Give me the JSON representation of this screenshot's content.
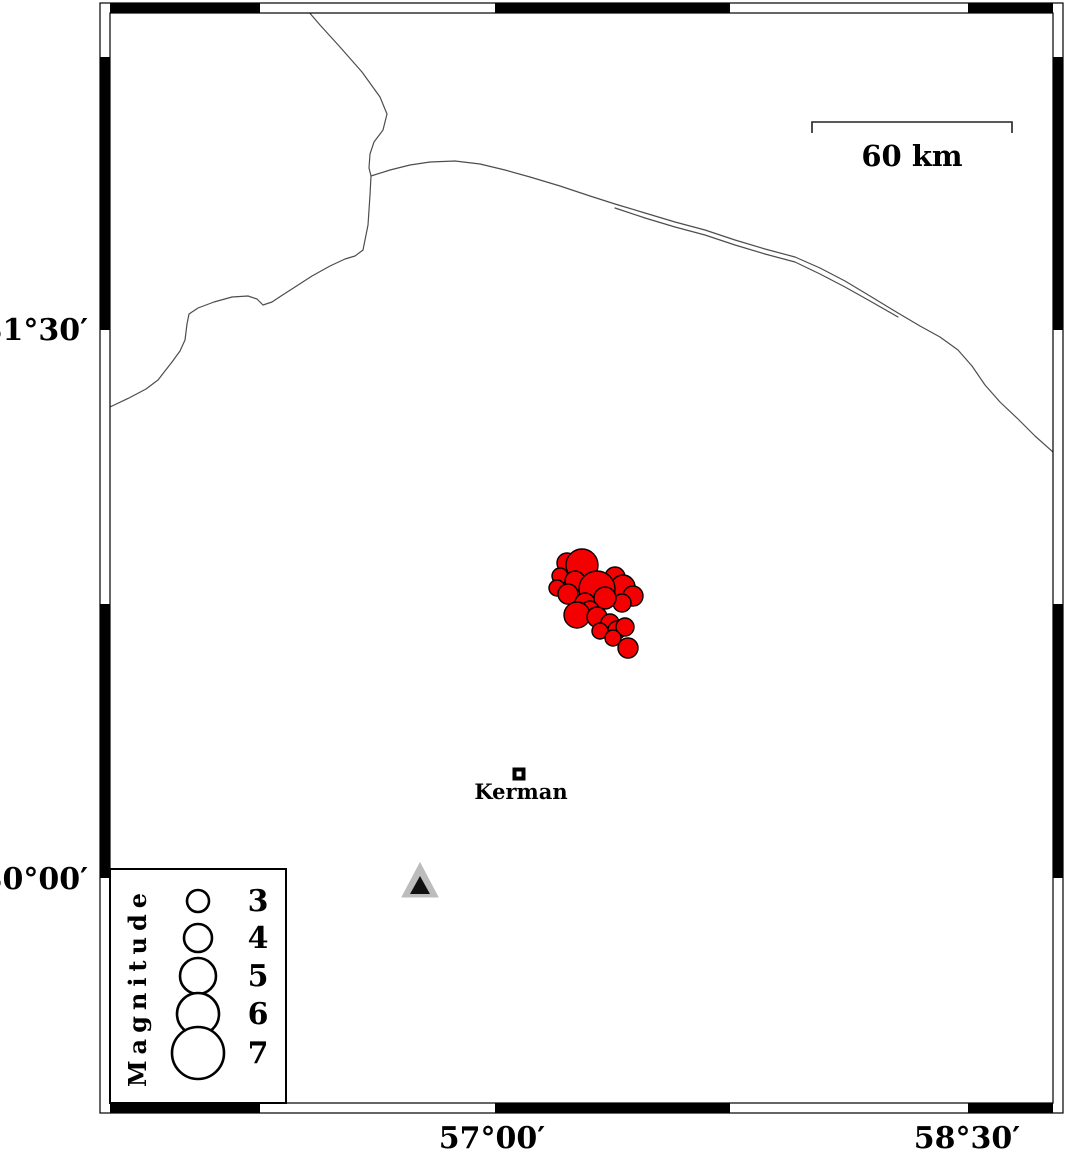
{
  "figure": {
    "title": "Kerman seismicity map",
    "width": 1066,
    "height": 1155,
    "background": "#ffffff"
  },
  "frame": {
    "outer": {
      "x": 100,
      "y": 3,
      "w": 963,
      "h": 1110
    },
    "inner": {
      "x": 110,
      "y": 13,
      "w": 943,
      "h": 1090
    },
    "band_color": "#000000",
    "top_black_segments_x": [
      [
        110,
        260
      ],
      [
        495,
        730
      ],
      [
        968,
        1053
      ]
    ],
    "bottom_black_segments_x": [
      [
        110,
        260
      ],
      [
        495,
        730
      ],
      [
        968,
        1053
      ]
    ],
    "left_black_segments_y": [
      [
        57,
        330
      ],
      [
        604,
        878
      ]
    ],
    "right_black_segments_y": [
      [
        57,
        330
      ],
      [
        604,
        878
      ]
    ]
  },
  "axis_labels": {
    "font_size": 30,
    "left": [
      {
        "text": "31°30′",
        "x": 88,
        "baseline": 340
      },
      {
        "text": "30°00′",
        "x": 88,
        "baseline": 889
      }
    ],
    "bottom": [
      {
        "text": "57°00′",
        "x": 492,
        "baseline": 1148
      },
      {
        "text": "58°30′",
        "x": 967,
        "baseline": 1148
      }
    ]
  },
  "scale_bar": {
    "x1": 812,
    "x2": 1012,
    "y": 122,
    "tick_drop": 11,
    "label": "60 km",
    "label_x": 912,
    "label_baseline": 166,
    "font_size": 29
  },
  "city": {
    "label": "Kerman",
    "square_cx": 519,
    "square_cy": 774,
    "square_size": 13,
    "inner_size": 5,
    "label_x": 521,
    "label_baseline": 799,
    "font_size": 21
  },
  "station": {
    "outer_points": "402,897 438,897 420,863",
    "inner_points": "410,894 430,894 420,876",
    "outer_fill": "#bcbcbc",
    "inner_fill": "#101010"
  },
  "earthquakes": {
    "fill": "#f40000",
    "stroke": "#000000",
    "stroke_width": 1.4,
    "points_xyr": [
      [
        567,
        563,
        10
      ],
      [
        582,
        565,
        16
      ],
      [
        560,
        576,
        8
      ],
      [
        575,
        581,
        10
      ],
      [
        557,
        588,
        8
      ],
      [
        615,
        577,
        10
      ],
      [
        623,
        587,
        12
      ],
      [
        568,
        594,
        10
      ],
      [
        597,
        589,
        18
      ],
      [
        633,
        596,
        10
      ],
      [
        585,
        603,
        10
      ],
      [
        622,
        603,
        9
      ],
      [
        605,
        598,
        11
      ],
      [
        590,
        610,
        9
      ],
      [
        577,
        615,
        13
      ],
      [
        597,
        617,
        10
      ],
      [
        610,
        623,
        9
      ],
      [
        617,
        630,
        9
      ],
      [
        625,
        627,
        9
      ],
      [
        600,
        631,
        8
      ],
      [
        613,
        638,
        8
      ],
      [
        628,
        648,
        10
      ]
    ]
  },
  "coastlines": {
    "color": "#4d4d4d",
    "width": 1.2,
    "paths": [
      [
        [
          308,
          11
        ],
        [
          320,
          25
        ],
        [
          340,
          47
        ],
        [
          362,
          72
        ],
        [
          380,
          97
        ],
        [
          387,
          114
        ],
        [
          383,
          130
        ],
        [
          374,
          142
        ],
        [
          370,
          154
        ],
        [
          369,
          168
        ],
        [
          371,
          176
        ]
      ],
      [
        [
          371,
          176
        ],
        [
          370,
          195
        ],
        [
          368,
          225
        ],
        [
          363,
          250
        ],
        [
          355,
          256
        ],
        [
          345,
          259
        ],
        [
          330,
          266
        ],
        [
          312,
          276
        ],
        [
          295,
          287
        ],
        [
          281,
          296
        ],
        [
          272,
          302
        ],
        [
          263,
          305
        ],
        [
          257,
          299
        ],
        [
          248,
          296
        ],
        [
          232,
          297
        ],
        [
          214,
          302
        ],
        [
          198,
          308
        ],
        [
          189,
          314
        ],
        [
          187,
          324
        ],
        [
          185,
          340
        ],
        [
          180,
          351
        ],
        [
          172,
          362
        ],
        [
          165,
          371
        ],
        [
          158,
          380
        ],
        [
          146,
          389
        ],
        [
          129,
          398
        ],
        [
          110,
          407
        ]
      ],
      [
        [
          371,
          176
        ],
        [
          390,
          170
        ],
        [
          410,
          165
        ],
        [
          430,
          162
        ],
        [
          455,
          161
        ],
        [
          480,
          164
        ],
        [
          505,
          170
        ],
        [
          530,
          177
        ],
        [
          560,
          186
        ],
        [
          590,
          196
        ],
        [
          615,
          204
        ],
        [
          645,
          213
        ],
        [
          675,
          222
        ],
        [
          705,
          230
        ],
        [
          735,
          240
        ],
        [
          765,
          249
        ],
        [
          795,
          257
        ],
        [
          820,
          268
        ],
        [
          845,
          281
        ],
        [
          870,
          296
        ],
        [
          898,
          313
        ],
        [
          920,
          326
        ],
        [
          940,
          337
        ],
        [
          958,
          350
        ],
        [
          972,
          366
        ],
        [
          985,
          385
        ],
        [
          1000,
          402
        ],
        [
          1018,
          419
        ],
        [
          1035,
          436
        ],
        [
          1053,
          452
        ]
      ],
      [
        [
          615,
          208
        ],
        [
          645,
          218
        ],
        [
          675,
          227
        ],
        [
          705,
          235
        ],
        [
          735,
          245
        ],
        [
          765,
          254
        ],
        [
          795,
          262
        ],
        [
          820,
          274
        ],
        [
          845,
          287
        ],
        [
          870,
          301
        ],
        [
          898,
          317
        ]
      ]
    ]
  },
  "legend": {
    "box": {
      "x": 110,
      "y": 869,
      "w": 176,
      "h": 234
    },
    "title": "Magnitude",
    "title_cx": 146,
    "title_cy": 987,
    "title_font_size": 24,
    "title_letter_spacing": 6,
    "circle_x": 198,
    "number_x": 258,
    "number_font_size": 30,
    "circle_stroke_width": 2.6,
    "entries": [
      {
        "mag": "3",
        "cy": 901,
        "r": 11
      },
      {
        "mag": "4",
        "cy": 938,
        "r": 14
      },
      {
        "mag": "5",
        "cy": 976,
        "r": 18
      },
      {
        "mag": "6",
        "cy": 1014,
        "r": 21
      },
      {
        "mag": "7",
        "cy": 1053,
        "r": 26
      }
    ]
  }
}
